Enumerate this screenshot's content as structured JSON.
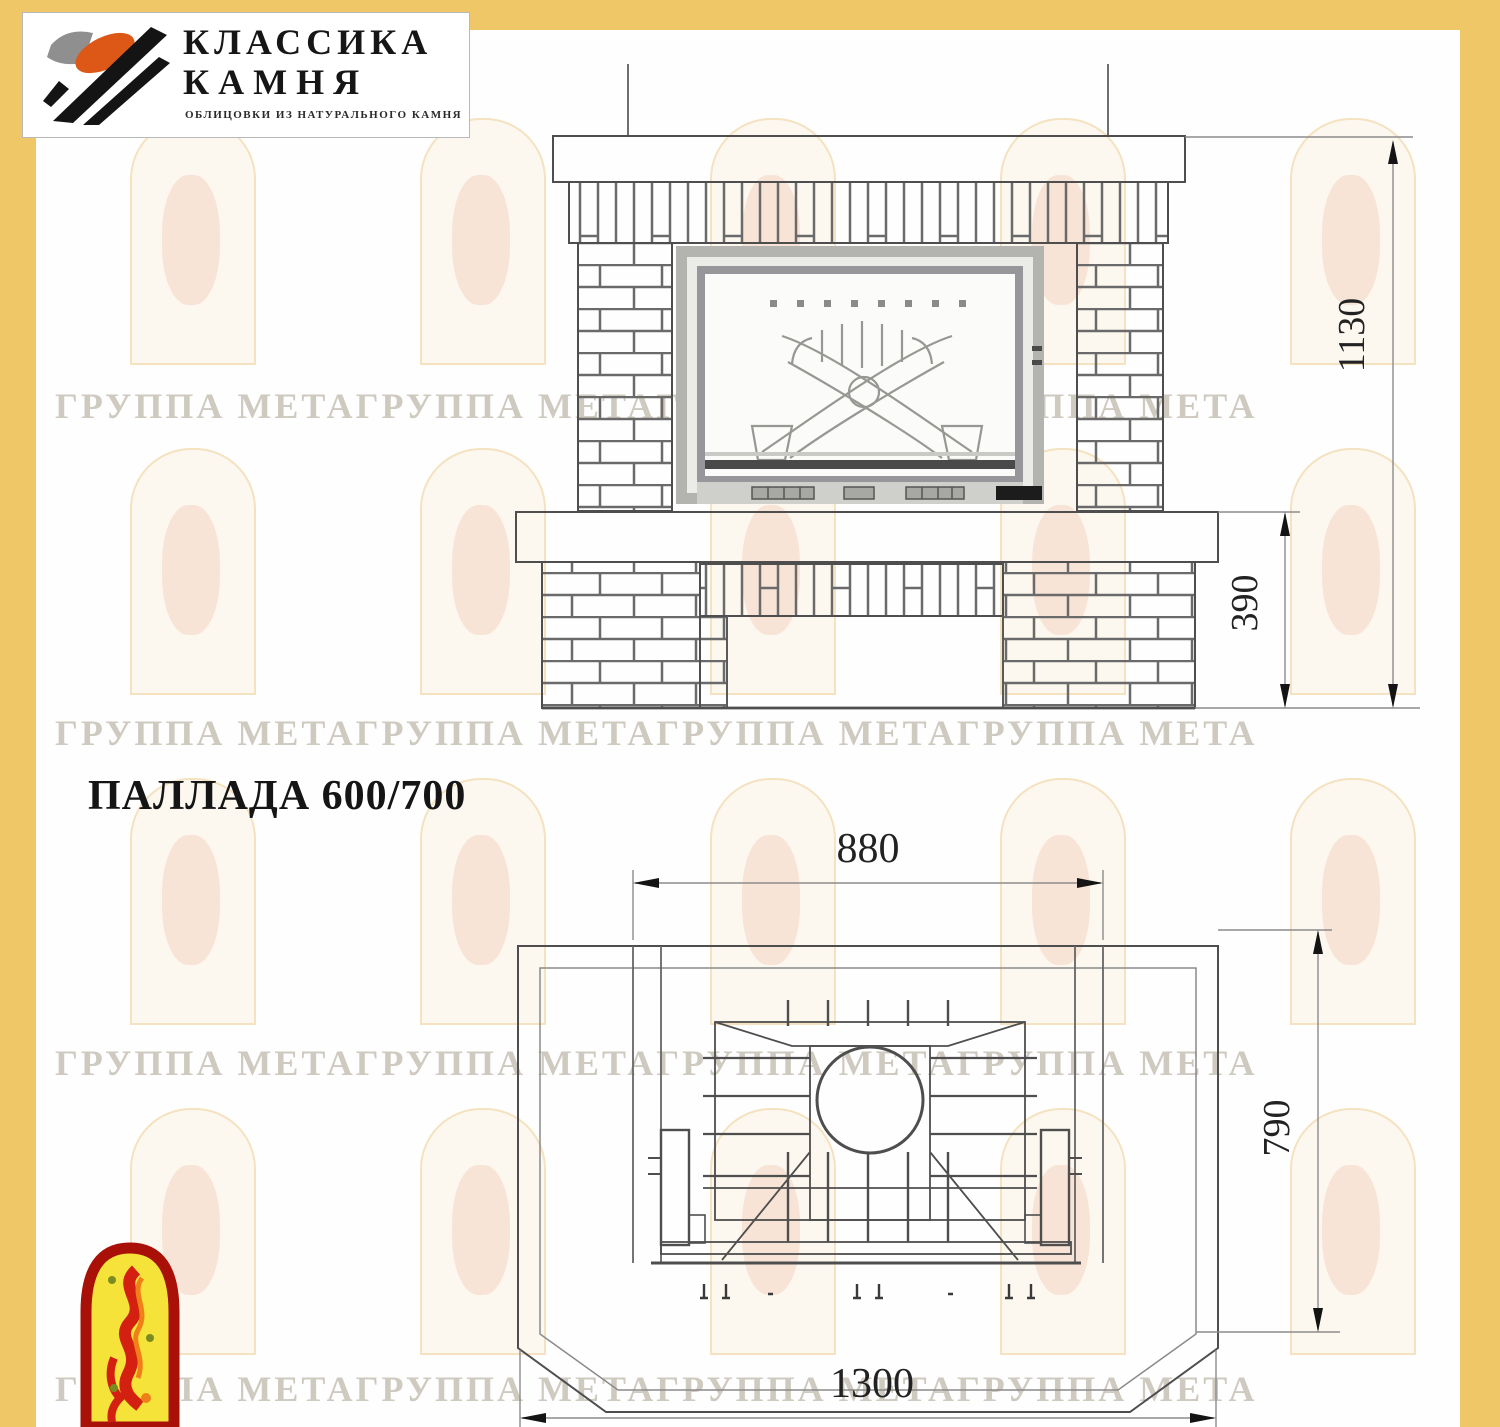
{
  "logo": {
    "line1": "КЛАССИКА",
    "line2": "КАМНЯ",
    "tagline": "ОБЛИЦОВКИ ИЗ НАТУРАЛЬНОГО КАМНЯ"
  },
  "title": "ПАЛЛАДА 600/700",
  "watermark": {
    "row_text": "ГРУППА МЕТАГРУППА МЕТАГРУППА МЕТАГРУППА МЕТА"
  },
  "dimensions": {
    "front_total_height": "1130",
    "front_hearth_height": "390",
    "plan_firebox_width": "880",
    "plan_depth": "790",
    "plan_total_width": "1300"
  },
  "colors": {
    "accent_border": "#F0C766",
    "drawing_line": "#4e4e4e",
    "dim_line": "#8c8c8c",
    "logo_orange": "#DD5716",
    "emblem_red": "#C41708",
    "emblem_yellow": "#F5E33A"
  }
}
